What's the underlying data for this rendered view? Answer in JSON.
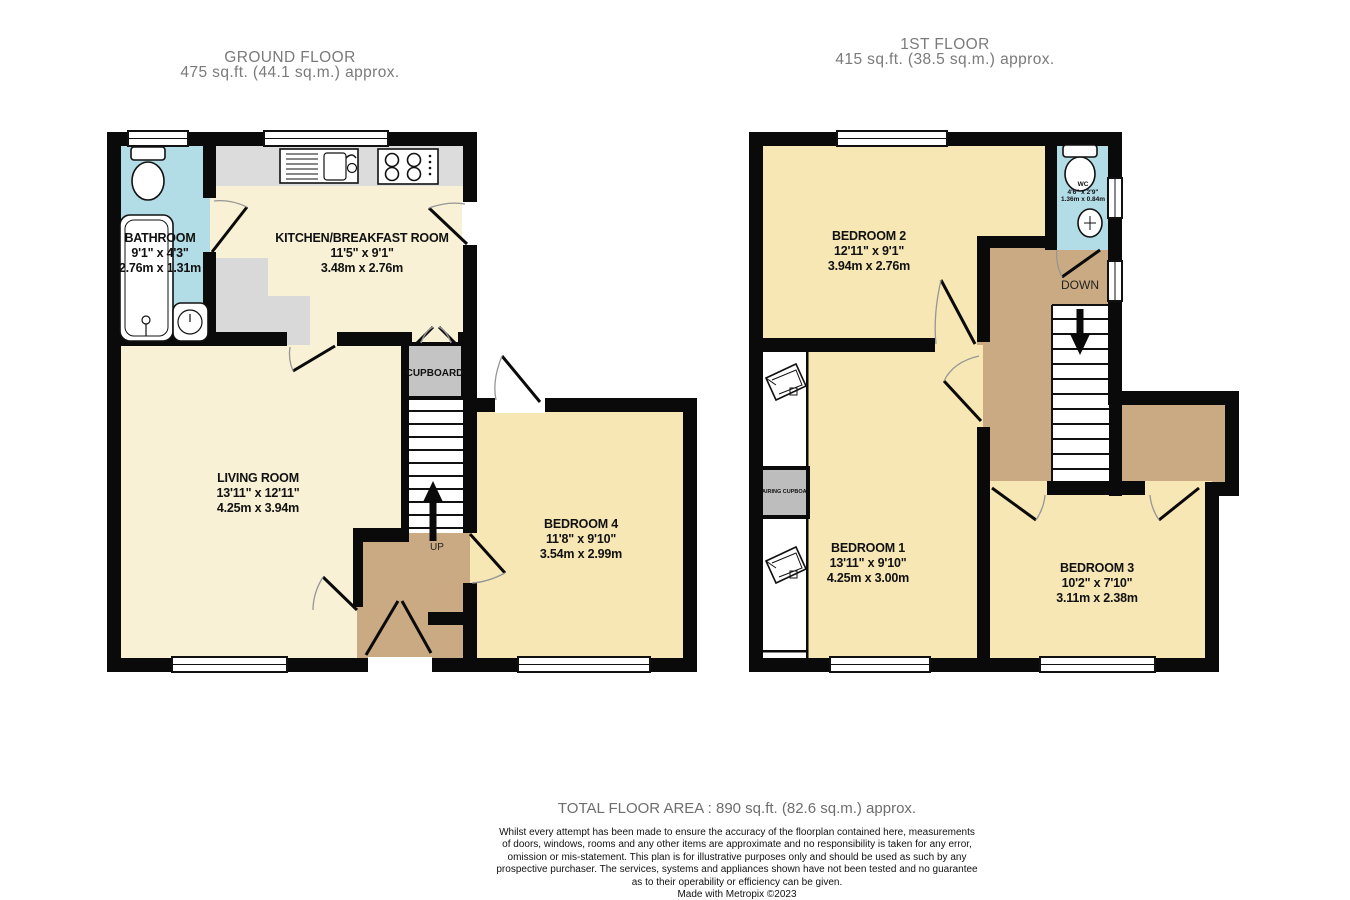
{
  "ground_floor": {
    "title": "GROUND FLOOR",
    "area": "475 sq.ft. (44.1 sq.m.) approx.",
    "rooms": {
      "bathroom": {
        "name": "BATHROOM",
        "imperial": "9'1\" x 4'3\"",
        "metric": "2.76m x 1.31m"
      },
      "kitchen": {
        "name": "KITCHEN/BREAKFAST ROOM",
        "imperial": "11'5\" x 9'1\"",
        "metric": "3.48m x 2.76m"
      },
      "living": {
        "name": "LIVING ROOM",
        "imperial": "13'11\" x 12'11\"",
        "metric": "4.25m x 3.94m"
      },
      "bedroom4": {
        "name": "BEDROOM 4",
        "imperial": "11'8\" x 9'10\"",
        "metric": "3.54m x 2.99m"
      }
    },
    "labels": {
      "cupboard": "CUPBOARD",
      "up": "UP"
    }
  },
  "first_floor": {
    "title": "1ST FLOOR",
    "area": "415 sq.ft. (38.5 sq.m.) approx.",
    "rooms": {
      "bedroom2": {
        "name": "BEDROOM 2",
        "imperial": "12'11\" x 9'1\"",
        "metric": "3.94m x 2.76m"
      },
      "bedroom1": {
        "name": "BEDROOM 1",
        "imperial": "13'11\" x 9'10\"",
        "metric": "4.25m x 3.00m"
      },
      "bedroom3": {
        "name": "BEDROOM 3",
        "imperial": "10'2\" x 7'10\"",
        "metric": "3.11m x 2.38m"
      },
      "wc": {
        "name": "WC",
        "imperial": "4'6\" x 2'9\"",
        "metric": "1.36m x 0.84m"
      }
    },
    "labels": {
      "down": "DOWN",
      "airing_cupboard": "AIRING CUPBOARD"
    }
  },
  "footer": {
    "total": "TOTAL FLOOR AREA : 890 sq.ft. (82.6 sq.m.) approx.",
    "disclaimer_lines": [
      "Whilst every attempt has been made to ensure the accuracy of the floorplan contained here, measurements",
      "of doors, windows, rooms and any other items are approximate and no responsibility is taken for any error,",
      "omission or mis-statement. This plan is for illustrative purposes only and should be used as such by any",
      "prospective purchaser. The services, systems and appliances shown have not been tested and no guarantee",
      "as to their operability or efficiency can be given."
    ],
    "credit": "Made with Metropix ©2023"
  },
  "colors": {
    "wall": "#0a0a0a",
    "room_cream": "#f8f1d6",
    "room_yellow": "#f6e7b5",
    "wet_blue": "#b2dce6",
    "hall_tan": "#c9aa82",
    "counter_gray": "#dcdcdc",
    "cupboard_gray": "#c4c4c4"
  }
}
